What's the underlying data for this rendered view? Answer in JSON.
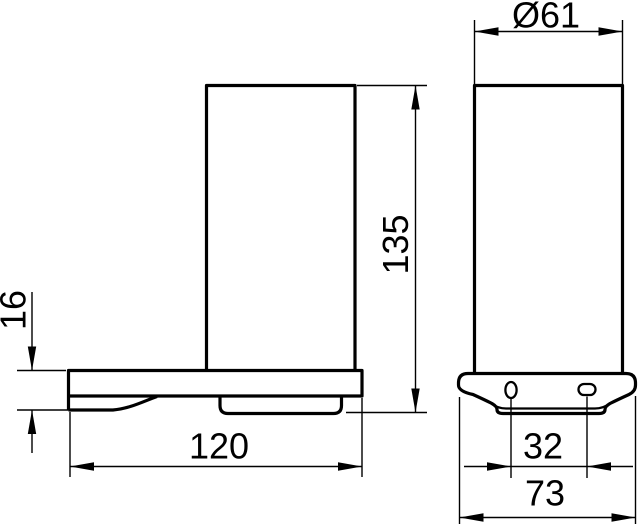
{
  "dims": {
    "diameter": "Ø61",
    "height": "135",
    "thickness": "16",
    "depth": "120",
    "hole_spacing": "32",
    "width": "73"
  },
  "colors": {
    "line": "#000000",
    "background": "#ffffff"
  }
}
